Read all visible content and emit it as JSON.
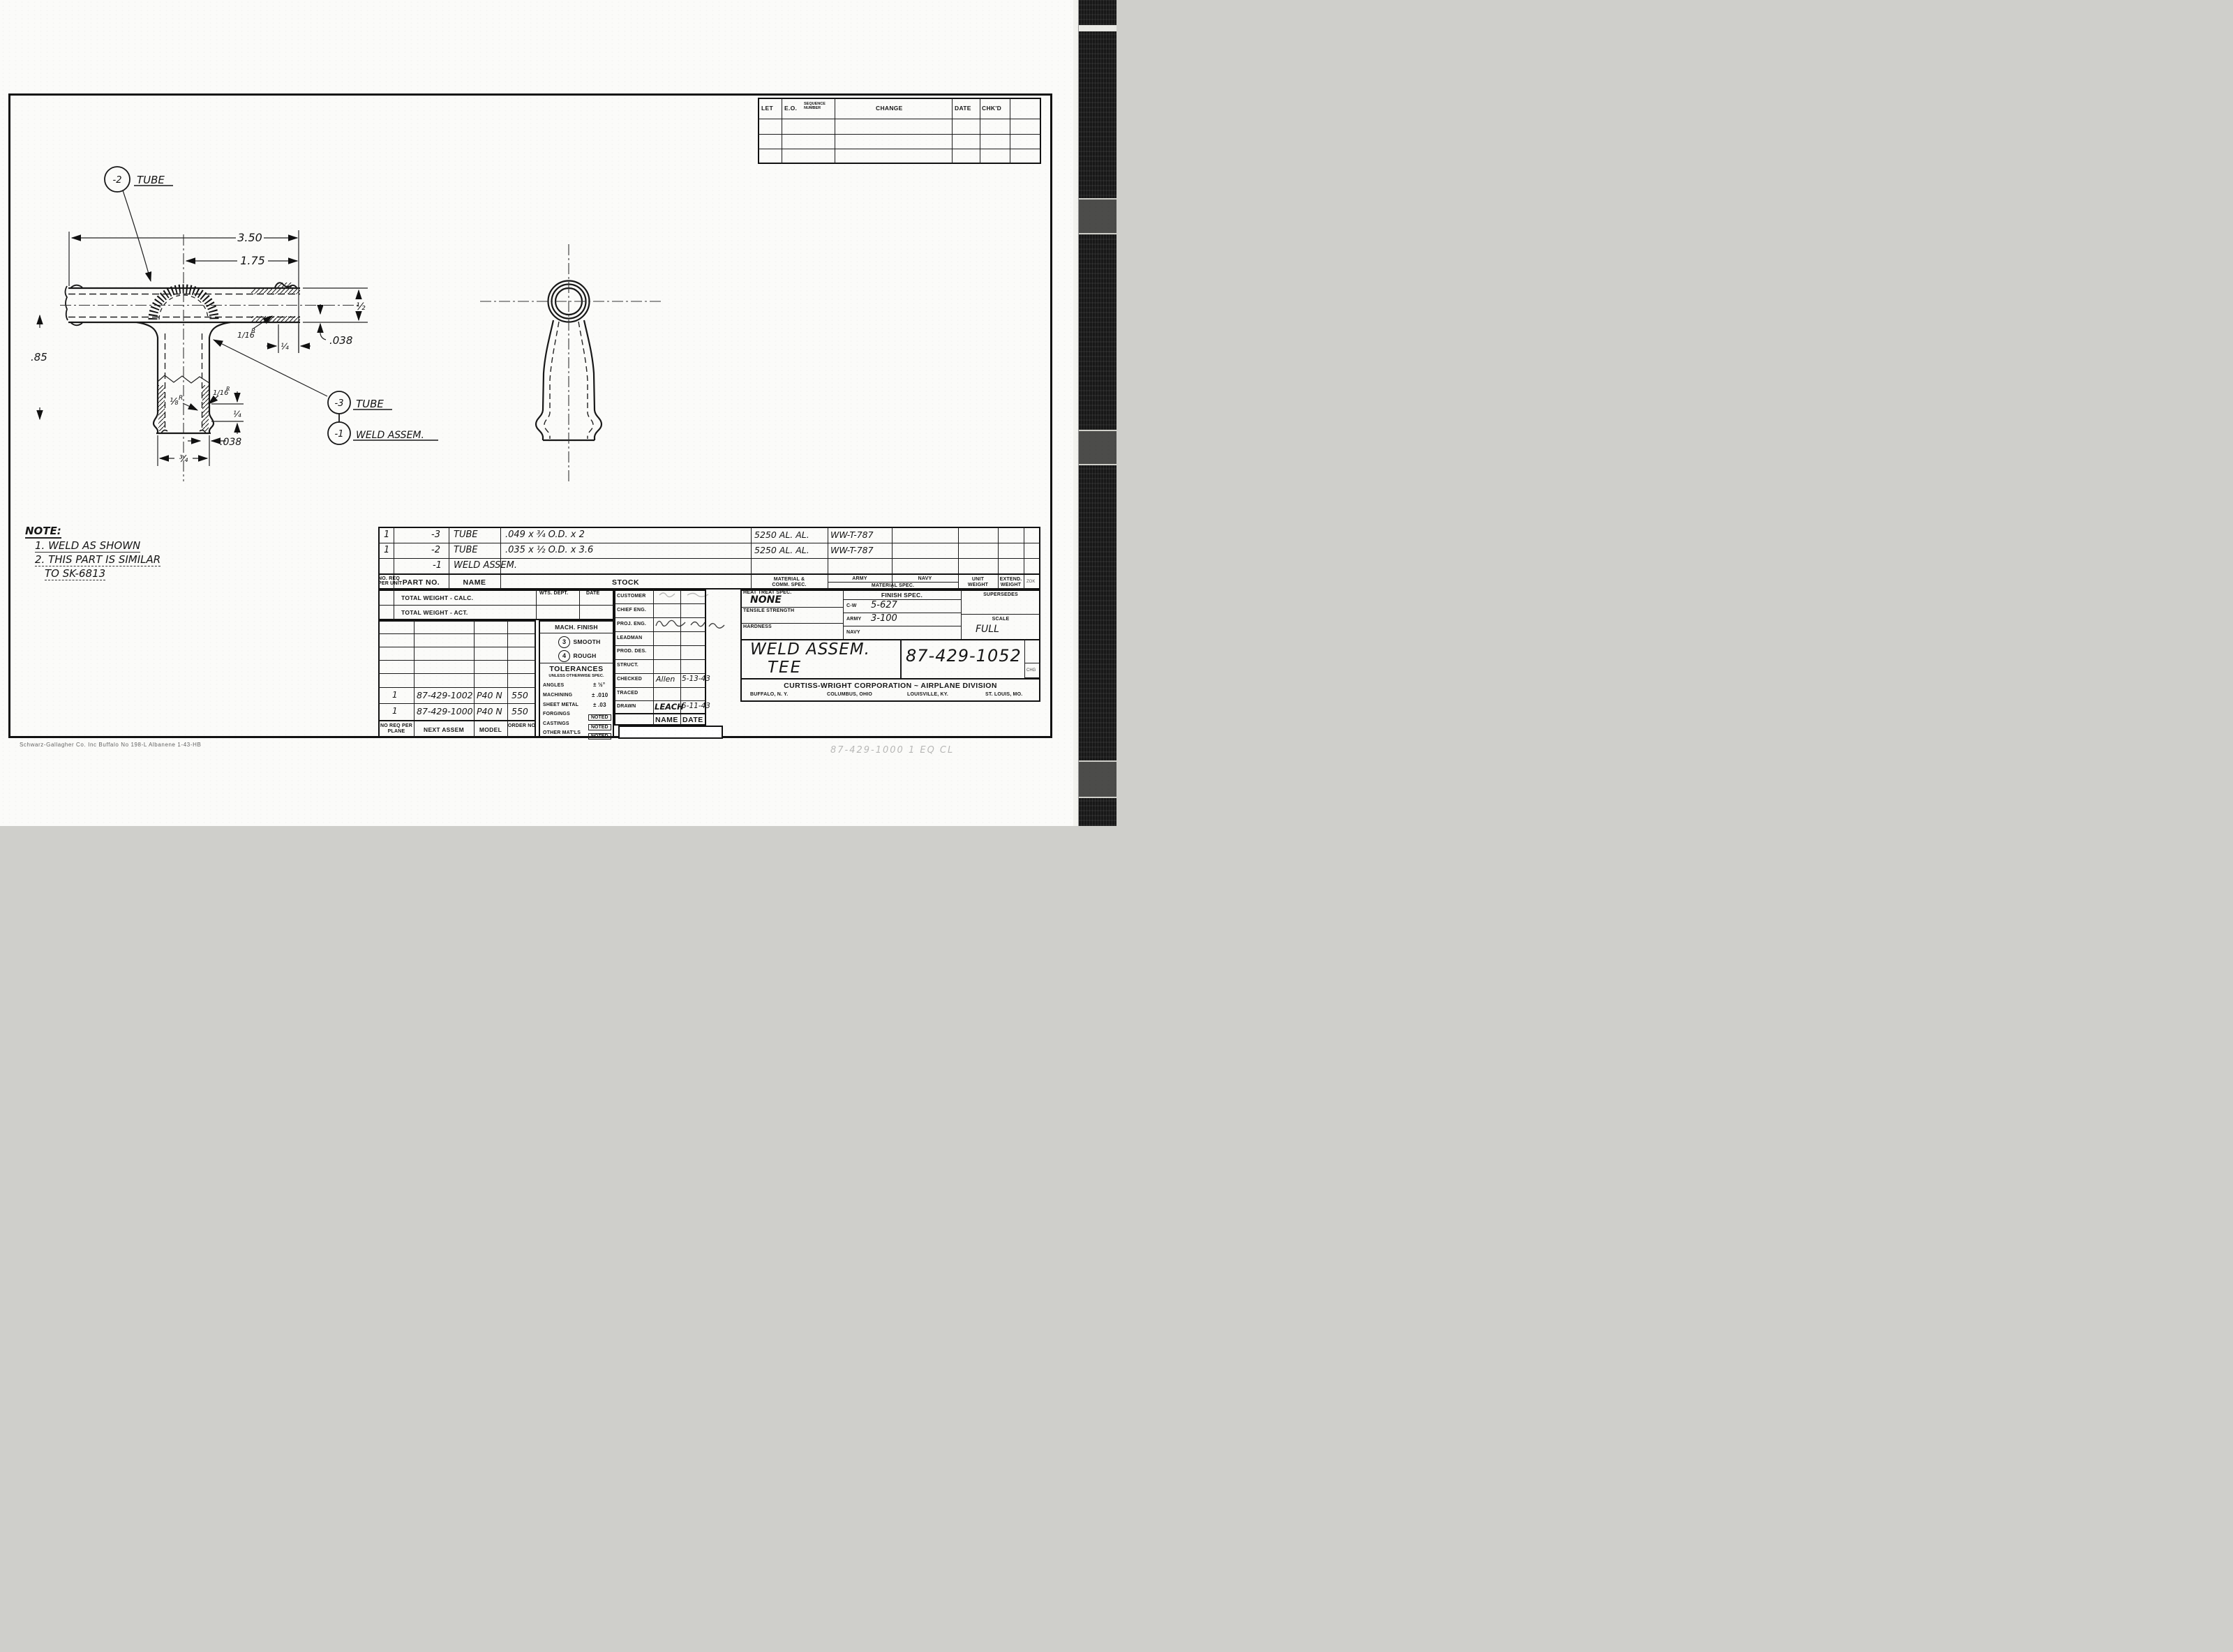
{
  "revision_table": {
    "col_let": "LET",
    "col_eo": "E.O.",
    "col_seq": "SEQUENCE NUMBER",
    "col_change": "CHANGE",
    "col_date": "DATE",
    "col_chkd": "CHK'D"
  },
  "drawing": {
    "balloon_minus2": "-2",
    "balloon_minus2_label": "TUBE",
    "balloon_minus3": "-3",
    "balloon_minus3_label": "TUBE",
    "balloon_minus1": "-1",
    "balloon_minus1_label": "WELD ASSEM.",
    "dims": {
      "overall": "3.50",
      "to_center": "1.75",
      "tube_od": "½",
      "tube_wall": ".038",
      "weld_fillet_num": "1/16",
      "weld_fillet_r": "R",
      "insert_depth": "¼",
      "branch_height": ".85",
      "radius_18": "⅛",
      "radius_18_r": "R",
      "radius_116": "1/16",
      "radius_116_r": "R",
      "end_depth": "¼",
      "branch_wall": ".038",
      "branch_od": "¾"
    }
  },
  "note": {
    "title": "NOTE:",
    "line1": "1. WELD AS SHOWN",
    "line2": "2. THIS PART IS SIMILAR",
    "line3": "TO SK-6813"
  },
  "parts_list": {
    "headers": {
      "qty1": "NO. REQ",
      "qty2": "PER UNIT",
      "part_no": "PART NO.",
      "name": "NAME",
      "stock": "STOCK",
      "material1": "MATERIAL &",
      "material2": "COMM. SPEC.",
      "army": "ARMY",
      "navy": "NAVY",
      "material_spec": "MATERIAL SPEC.",
      "unit1": "UNIT",
      "unit2": "WEIGHT",
      "ext1": "EXTEND.",
      "ext2": "WEIGHT",
      "zok": "ZOK"
    },
    "rows": [
      {
        "qty": "1",
        "part_no": "-3",
        "name": "TUBE",
        "stock": ".049 x ¾ O.D. x 2",
        "material": "5250 AL. AL.",
        "spec": "WW-T-787"
      },
      {
        "qty": "1",
        "part_no": "-2",
        "name": "TUBE",
        "stock": ".035 x ½ O.D. x 3.6",
        "material": "5250 AL. AL.",
        "spec": "WW-T-787"
      },
      {
        "qty": "",
        "part_no": "-1",
        "name": "WELD ASSEM.",
        "stock": "",
        "material": "",
        "spec": ""
      }
    ]
  },
  "weight_block": {
    "calc": "TOTAL WEIGHT - CALC.",
    "act": "TOTAL WEIGHT - ACT.",
    "wts_dept": "WTS. DEPT.",
    "date": "DATE"
  },
  "mach_finish": {
    "title": "MACH. FINISH",
    "smooth_num": "3",
    "smooth_label": "SMOOTH",
    "rough_num": "4",
    "rough_label": "ROUGH"
  },
  "tolerances": {
    "title": "TOLERANCES",
    "subtitle": "UNLESS OTHERWISE SPEC.",
    "angles_label": "ANGLES",
    "angles_value": "± ½°",
    "machining_label": "MACHINING",
    "machining_value": "± .010",
    "sheet_metal_label": "SHEET METAL",
    "sheet_metal_value": "± .03",
    "forgings_label": "FORGINGS",
    "forgings_value": "NOTED",
    "castings_label": "CASTINGS",
    "castings_value": "NOTED",
    "other_label": "OTHER MAT'LS",
    "other_value": "NOTED"
  },
  "signoff": {
    "labels": [
      "CUSTOMER",
      "CHIEF ENG.",
      "PROJ. ENG.",
      "LEADMAN",
      "PROD. DES.",
      "STRUCT.",
      "CHECKED",
      "TRACED",
      "DRAWN"
    ],
    "checked_name": "Allen",
    "checked_date": "5-13-43",
    "drawn_name": "LEACH",
    "drawn_date": "5-11-43",
    "footer_name": "NAME",
    "footer_date": "DATE"
  },
  "next_assem": {
    "rows": [
      {
        "qty": "1",
        "assem": "87-429-1002",
        "model": "P40 N",
        "order": "550"
      },
      {
        "qty": "1",
        "assem": "87-429-1000",
        "model": "P40 N",
        "order": "550"
      }
    ],
    "footer_qty": "NO REQ PER PLANE",
    "footer_assem": "NEXT ASSEM",
    "footer_model": "MODEL",
    "footer_order": "ORDER NO"
  },
  "specs": {
    "heat_treat_label": "HEAT TREAT SPEC.",
    "heat_treat_value": "NONE",
    "tensile_label": "TENSILE STRENGTH",
    "hardness_label": "HARDNESS",
    "finish_label": "FINISH SPEC.",
    "cw_label": "C-W",
    "cw_value": "5-627",
    "army_label": "ARMY",
    "army_value": "3-100",
    "navy_label": "NAVY",
    "supersedes_label": "SUPERSEDES",
    "scale_label": "SCALE",
    "scale_value": "FULL",
    "chg": "CHG"
  },
  "title_block": {
    "title_line1": "WELD ASSEM.",
    "title_line2": "TEE",
    "drawing_number": "87-429-1052",
    "company": "CURTISS-WRIGHT CORPORATION ~ AIRPLANE DIVISION",
    "loc1": "BUFFALO, N. Y.",
    "loc2": "COLUMBUS, OHIO",
    "loc3": "LOUISVILLE, KY.",
    "loc4": "ST. LOUIS, MO."
  },
  "footer": {
    "imprint": "Schwarz-Gallagher Co.  Inc  Buffalo   No 198-L Albanene   1-43-HB",
    "pencil_note": "87-429-1000     1 EQ     CL"
  }
}
